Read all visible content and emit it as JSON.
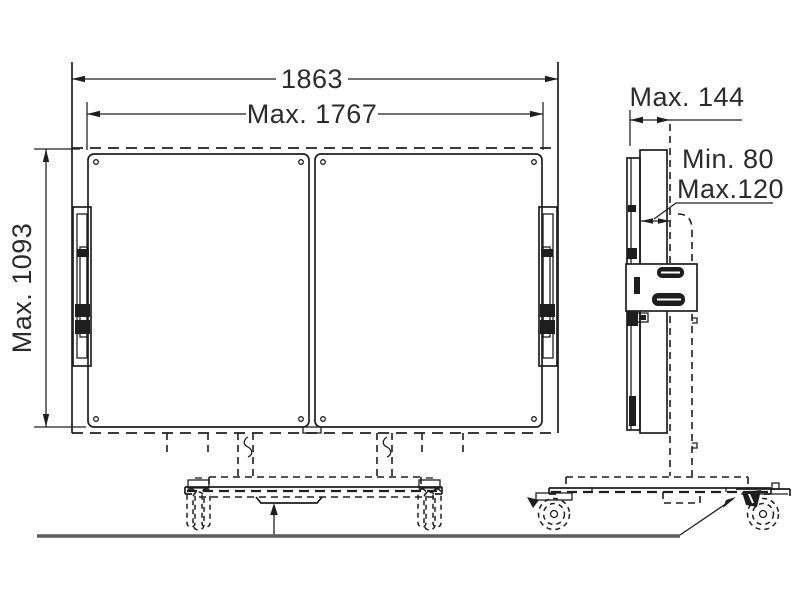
{
  "dimensions": {
    "overall_width": "1863",
    "panel_width": "Max. 1767",
    "panel_height": "Max. 1093",
    "depth": "Max. 144",
    "gap_min": "Min. 80",
    "gap_max": "Max.120"
  },
  "colors": {
    "line": "#1e1e1e",
    "ground": "#5c5c5c",
    "background": "#ffffff"
  }
}
